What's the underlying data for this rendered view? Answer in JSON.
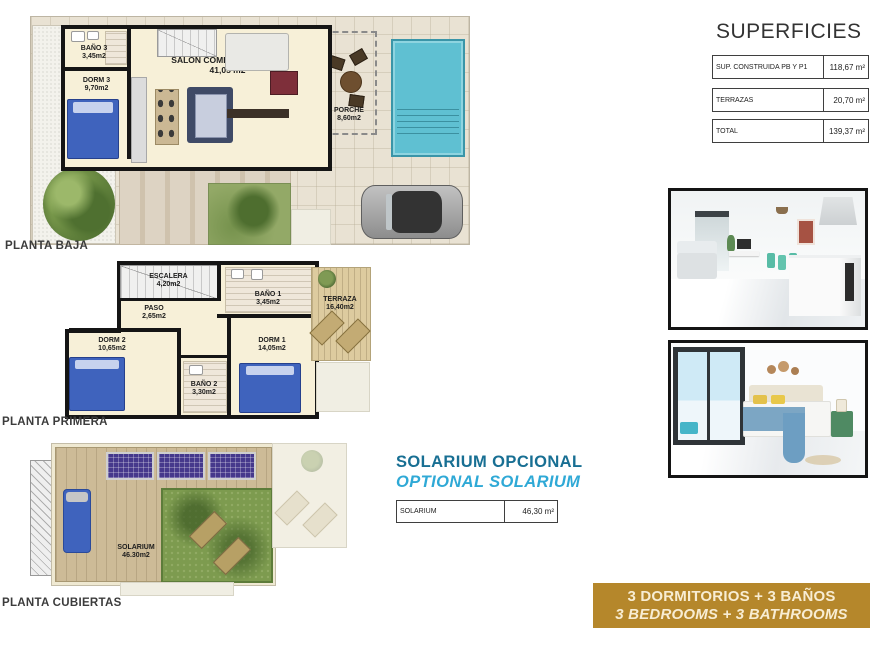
{
  "superficies": {
    "title": "SUPERFICIES",
    "rows": [
      {
        "label": "SUP. CONSTRUIDA PB Y P1",
        "value": "118,67 m²"
      },
      {
        "label": "TERRAZAS",
        "value": "20,70 m²"
      },
      {
        "label": "TOTAL",
        "value": "139,37 m²"
      }
    ]
  },
  "floors": {
    "baja": {
      "label": "PLANTA BAJA",
      "rooms": {
        "bano3": {
          "name": "BAÑO 3",
          "area": "3,45m2"
        },
        "dorm3": {
          "name": "DORM 3",
          "area": "9,70m2"
        },
        "salon": {
          "name": "SALON COMEDOR COCINA",
          "area": "41,05 m2"
        },
        "porche": {
          "name": "PORCHE",
          "area": "8,60m2"
        }
      }
    },
    "primera": {
      "label": "PLANTA PRIMERA",
      "rooms": {
        "escalera": {
          "name": "ESCALERA",
          "area": "4,20m2"
        },
        "paso": {
          "name": "PASO",
          "area": "2,65m2"
        },
        "bano1": {
          "name": "BAÑO 1",
          "area": "3,45m2"
        },
        "dorm2": {
          "name": "DORM 2",
          "area": "10,65m2"
        },
        "dorm1": {
          "name": "DORM 1",
          "area": "14,05m2"
        },
        "bano2": {
          "name": "BAÑO 2",
          "area": "3,30m2"
        },
        "terraza": {
          "name": "TERRAZA",
          "area": "16,40m2"
        }
      }
    },
    "cubiertas": {
      "label": "PLANTA CUBIERTAS",
      "rooms": {
        "solarium": {
          "name": "SOLARIUM",
          "area": "46.30m2"
        }
      }
    }
  },
  "solarium_section": {
    "title": "SOLARIUM OPCIONAL",
    "subtitle": "OPTIONAL SOLARIUM",
    "table": {
      "label": "SOLARIUM",
      "value": "46,30 m²"
    }
  },
  "banner": {
    "line1": "3 DORMITORIOS + 3 BAÑOS",
    "line2": "3 BEDROOMS + 3 BATHROOMS"
  },
  "colors": {
    "banner_bg": "#b5872b",
    "banner_text": "#f8edd3",
    "solarium_title": "#186f93",
    "solarium_subtitle": "#2fa9d6",
    "pool": "#5fc0d2",
    "bed_blue": "#3f63bd",
    "solar_panel": "#46398c"
  }
}
